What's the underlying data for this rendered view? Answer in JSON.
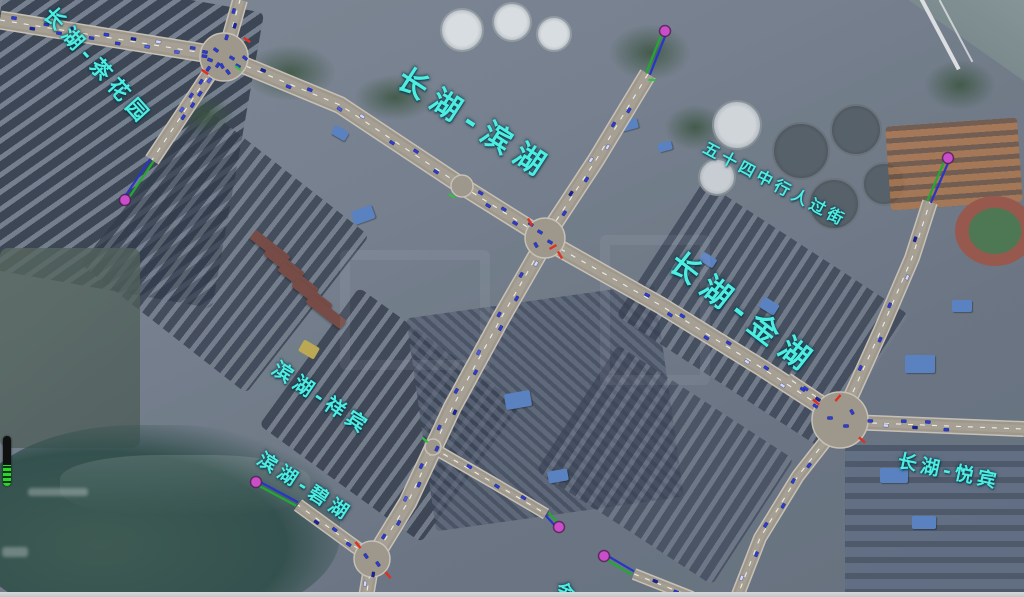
{
  "app": {
    "type": "traffic-simulation-map-view",
    "basemap": "satellite-imagery"
  },
  "colors": {
    "label_cyan": "#4deee2",
    "road_fill": "#9e978c",
    "road_casing": "#c6c0b6",
    "road_inner": "#a8a296",
    "lane_dash": "#f2f0ea",
    "vehicle_blue": "#2a3bd6",
    "vehicle_alt1": "#4a5be8",
    "vehicle_alt2": "#16249e",
    "vehicle_alt3": "#cfd6ff",
    "centroid_pink": "#c94fc9",
    "connector_green": "#23a834",
    "connector_blue": "#2736c4",
    "signal_red": "#e03020",
    "signal_green": "#30c040"
  },
  "road_labels": [
    {
      "text": "长湖-茶花园",
      "x": 55,
      "y": 4,
      "rotation": 48,
      "font_size": 21,
      "letter_spacing": 6
    },
    {
      "text": "长湖-滨湖",
      "x": 408,
      "y": 64,
      "rotation": 33,
      "font_size": 30,
      "letter_spacing": 9
    },
    {
      "text": "长湖-金湖",
      "x": 682,
      "y": 248,
      "rotation": 38,
      "font_size": 30,
      "letter_spacing": 9
    },
    {
      "text": "五十四中行人过街",
      "x": 708,
      "y": 140,
      "rotation": 28,
      "font_size": 16,
      "letter_spacing": 4
    },
    {
      "text": "滨湖-祥宾",
      "x": 280,
      "y": 358,
      "rotation": 34,
      "font_size": 20,
      "letter_spacing": 5
    },
    {
      "text": "滨湖-碧湖",
      "x": 264,
      "y": 450,
      "rotation": 33,
      "font_size": 19,
      "letter_spacing": 5
    },
    {
      "text": "长湖-悦宾",
      "x": 900,
      "y": 452,
      "rotation": 12,
      "font_size": 19,
      "letter_spacing": 4
    },
    {
      "text": "金",
      "x": 560,
      "y": 581,
      "rotation": 22,
      "font_size": 18,
      "letter_spacing": 0
    }
  ],
  "network": {
    "intersections": [
      {
        "id": "A",
        "x": 224,
        "y": 57,
        "r": 24
      },
      {
        "id": "B",
        "x": 462,
        "y": 186,
        "r": 11
      },
      {
        "id": "C",
        "x": 545,
        "y": 238,
        "r": 20
      },
      {
        "id": "D",
        "x": 840,
        "y": 420,
        "r": 28
      },
      {
        "id": "G",
        "x": 372,
        "y": 559,
        "r": 18
      },
      {
        "id": "X",
        "x": 433,
        "y": 447,
        "r": 8
      }
    ],
    "roads": [
      {
        "id": "A-west",
        "points": [
          [
            0,
            20
          ],
          [
            222,
            56
          ]
        ],
        "width": 16,
        "vehicles": {
          "count": 14,
          "t0": 0.04,
          "t1": 0.96
        }
      },
      {
        "id": "A-north",
        "points": [
          [
            226,
            50
          ],
          [
            240,
            0
          ]
        ],
        "width": 13,
        "vehicles": {
          "count": 3,
          "t0": 0.1,
          "t1": 0.9
        }
      },
      {
        "id": "A-B",
        "points": [
          [
            224,
            57
          ],
          [
            340,
            105
          ],
          [
            462,
            186
          ]
        ],
        "width": 15,
        "vehicles": {
          "count": 8,
          "t0": 0.08,
          "t1": 0.95
        }
      },
      {
        "id": "A-SW",
        "points": [
          [
            220,
            58
          ],
          [
            152,
            160
          ]
        ],
        "width": 13,
        "vehicles": {
          "count": 9,
          "t0": 0.02,
          "t1": 0.62
        }
      },
      {
        "id": "north",
        "points": [
          [
            648,
            74
          ],
          [
            596,
            160
          ],
          [
            546,
            236
          ]
        ],
        "width": 15,
        "vehicles": {
          "count": 7,
          "t0": 0.15,
          "t1": 0.92
        }
      },
      {
        "id": "B-C",
        "points": [
          [
            462,
            186
          ],
          [
            545,
            238
          ]
        ],
        "width": 15,
        "vehicles": {
          "count": 5,
          "t0": 0.1,
          "t1": 0.9
        }
      },
      {
        "id": "C-G",
        "points": [
          [
            546,
            240
          ],
          [
            500,
            320
          ],
          [
            452,
            408
          ],
          [
            408,
            502
          ],
          [
            375,
            556
          ]
        ],
        "width": 16,
        "vehicles": {
          "count": 16,
          "t0": 0.03,
          "t1": 0.97
        }
      },
      {
        "id": "C-D",
        "points": [
          [
            550,
            243
          ],
          [
            660,
            305
          ],
          [
            762,
            368
          ],
          [
            836,
            416
          ]
        ],
        "width": 15,
        "vehicles": {
          "count": 10,
          "t0": 0.3,
          "t1": 0.97
        }
      },
      {
        "id": "D-N",
        "points": [
          [
            843,
            414
          ],
          [
            882,
            328
          ],
          [
            912,
            258
          ],
          [
            930,
            202
          ]
        ],
        "width": 13,
        "vehicles": {
          "count": 5,
          "t0": 0.15,
          "t1": 0.9
        }
      },
      {
        "id": "D-E",
        "points": [
          [
            848,
            422
          ],
          [
            1024,
            429
          ]
        ],
        "width": 13,
        "vehicles": {
          "count": 6,
          "t0": 0.08,
          "t1": 0.6
        }
      },
      {
        "id": "D-SW",
        "points": [
          [
            834,
            430
          ],
          [
            798,
            476
          ],
          [
            760,
            538
          ],
          [
            737,
            597
          ]
        ],
        "width": 11,
        "vehicles": {
          "count": 6,
          "t0": 0.15,
          "t1": 0.95
        }
      },
      {
        "id": "D-NW",
        "points": [
          [
            836,
            410
          ],
          [
            788,
            378
          ]
        ],
        "width": 8,
        "vehicles": {
          "count": 2,
          "t0": 0.2,
          "t1": 0.8
        }
      },
      {
        "id": "G-W",
        "points": [
          [
            368,
            556
          ],
          [
            298,
            505
          ]
        ],
        "width": 11,
        "vehicles": {
          "count": 3,
          "t0": 0.15,
          "t1": 0.8
        }
      },
      {
        "id": "G-S",
        "points": [
          [
            372,
            562
          ],
          [
            366,
            597
          ]
        ],
        "width": 13,
        "vehicles": {
          "count": 2,
          "t0": 0.2,
          "t1": 0.8
        }
      },
      {
        "id": "S1",
        "points": [
          [
            433,
            448
          ],
          [
            492,
            482
          ],
          [
            546,
            514
          ]
        ],
        "width": 9,
        "vehicles": {
          "count": 3,
          "t0": 0.2,
          "t1": 0.9
        }
      },
      {
        "id": "S2",
        "points": [
          [
            634,
            574
          ],
          [
            692,
            597
          ]
        ],
        "width": 9,
        "vehicles": {
          "count": 2,
          "t0": 0.2,
          "t1": 0.9
        }
      }
    ],
    "centroids": [
      {
        "x": 125,
        "y": 200,
        "to": [
          152,
          160
        ]
      },
      {
        "x": 665,
        "y": 31,
        "to": [
          648,
          74
        ]
      },
      {
        "x": 948,
        "y": 158,
        "to": [
          929,
          202
        ]
      },
      {
        "x": 256,
        "y": 482,
        "to": [
          297,
          504
        ]
      },
      {
        "x": 559,
        "y": 527,
        "to": [
          547,
          514
        ]
      },
      {
        "x": 604,
        "y": 556,
        "to": [
          633,
          573
        ]
      }
    ],
    "signal_marks_red": [
      {
        "x": 205,
        "y": 72,
        "rot": 35
      },
      {
        "x": 247,
        "y": 40,
        "rot": 35
      },
      {
        "x": 530,
        "y": 222,
        "rot": 60
      },
      {
        "x": 560,
        "y": 255,
        "rot": 60
      },
      {
        "x": 816,
        "y": 402,
        "rot": 40
      },
      {
        "x": 862,
        "y": 440,
        "rot": 40
      },
      {
        "x": 358,
        "y": 545,
        "rot": 50
      },
      {
        "x": 388,
        "y": 575,
        "rot": 50
      },
      {
        "x": 553,
        "y": 247,
        "rot": -30
      },
      {
        "x": 838,
        "y": 398,
        "rot": -50
      }
    ],
    "signal_marks_green": [
      {
        "x": 238,
        "y": 68,
        "rot": 35
      },
      {
        "x": 452,
        "y": 196,
        "rot": 30
      },
      {
        "x": 652,
        "y": 80,
        "rot": 0
      },
      {
        "x": 425,
        "y": 440,
        "rot": 40
      }
    ],
    "loose_vehicles": [
      {
        "x": 210,
        "y": 60,
        "rot": 20
      },
      {
        "x": 222,
        "y": 66,
        "rot": 60
      },
      {
        "x": 232,
        "y": 58,
        "rot": 30
      },
      {
        "x": 216,
        "y": 50,
        "rot": 35
      },
      {
        "x": 228,
        "y": 72,
        "rot": 55
      },
      {
        "x": 238,
        "y": 66,
        "rot": 30
      },
      {
        "x": 205,
        "y": 52,
        "rot": 10
      },
      {
        "x": 245,
        "y": 58,
        "rot": 40
      },
      {
        "x": 540,
        "y": 232,
        "rot": 30
      },
      {
        "x": 550,
        "y": 242,
        "rot": 30
      },
      {
        "x": 536,
        "y": 245,
        "rot": 60
      },
      {
        "x": 830,
        "y": 418,
        "rot": 0
      },
      {
        "x": 846,
        "y": 426,
        "rot": 0
      },
      {
        "x": 852,
        "y": 412,
        "rot": 60
      },
      {
        "x": 366,
        "y": 556,
        "rot": 55
      },
      {
        "x": 378,
        "y": 564,
        "rot": 55
      }
    ]
  },
  "hud": {
    "level_indicator": {
      "x": 3,
      "y": 436,
      "width": 8,
      "height": 50,
      "fill_ratio": 0.42
    }
  },
  "window": {
    "bottom_edge_strip": true
  }
}
